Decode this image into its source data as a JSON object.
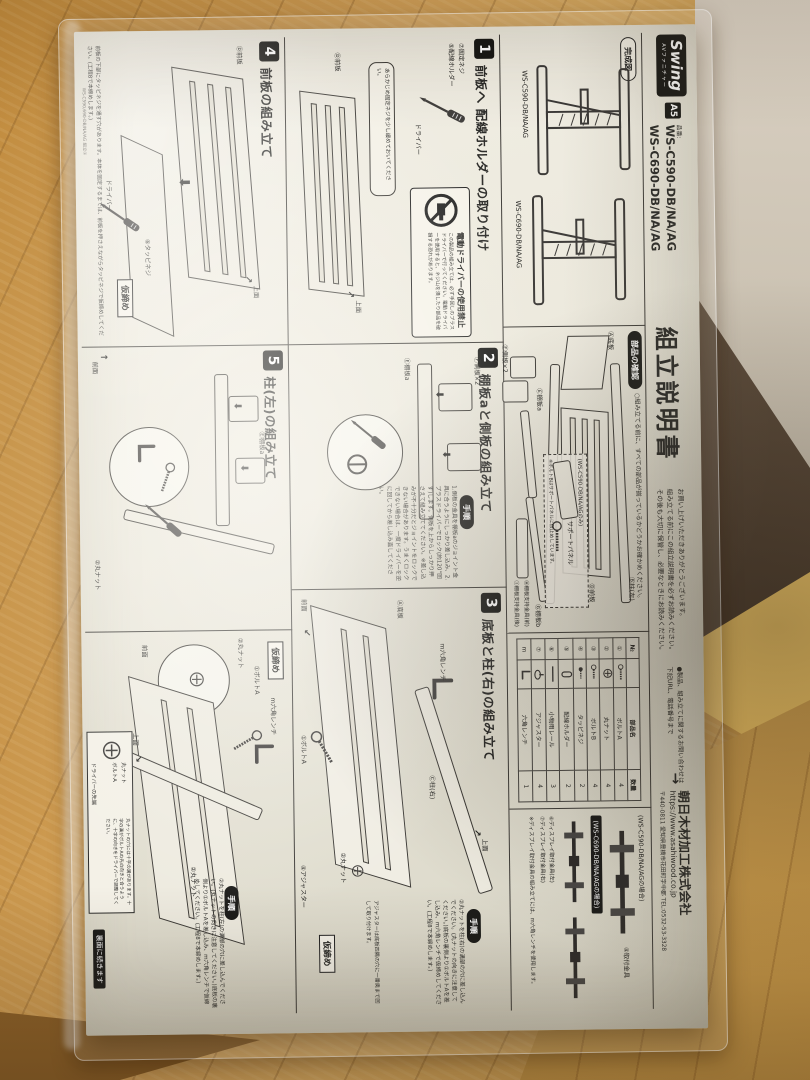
{
  "common": {
    "proc_badge": "手順",
    "temp_tighten": "仮締め",
    "top_face": "上面",
    "front_face": "前面"
  },
  "header": {
    "logo": "Swing",
    "logo_sub": "AVファニチャー",
    "size_badge": "A5",
    "part_no_label": "品番:",
    "model_1": "WS-C590-DB/NA/AG",
    "model_2": "WS-C690-DB/NA/AG",
    "title": "組立説明書",
    "intro_1": "お買い上げいただきありがとうございます。",
    "intro_2": "組み立てる前にこの組立説明書を必ずお読みください。",
    "intro_3": "その後も大切に保管し、必要なときにお読みください。",
    "contact_1": "●製品、組み立てに関するお問い合わせは",
    "contact_2": "下記URL、電話番号まで",
    "arrow": "→",
    "company": "朝日木材加工株式会社",
    "url": "https://www.asahiwood.co.jp",
    "address": "〒440-0811 愛知県豊橋市花田町字中郡 TEL:0532-53-3328"
  },
  "kansei": {
    "badge": "完成図",
    "model_1": "WS-C590-DB/NA/AG",
    "model_2": "WS-C690-DB/NA/AG"
  },
  "parts_check": {
    "badge": "部品の確認",
    "note": "○組み立てる前に、すべての部品が揃っているかどうかお確かめください。",
    "item_a": "Ⓐ底板",
    "item_b": "Ⓑ柱(左)",
    "item_c": "Ⓒ柱(右)",
    "item_d": "Ⓓ前板",
    "item_e": "Ⓔ棚板a",
    "item_f": "Ⓕ側板×2",
    "item_g": "Ⓖ棚板b",
    "item_h": "Ⓗ棚板支持金具(前)",
    "item_i": "Ⓘ棚板支持金具(後)",
    "support_case": "(WS-C590-DB/NA/AGのみ)",
    "support_label": "サポートパネル",
    "support_note": "※ボルトBはサポートパネルに仮止めしています。"
  },
  "parts_table": {
    "h_no": "№",
    "h_name": "部品名",
    "h_qty": "数量",
    "rows": [
      {
        "no": "①",
        "name": "ボルトA",
        "qty": "4"
      },
      {
        "no": "②",
        "name": "丸ナット",
        "qty": "4"
      },
      {
        "no": "③",
        "name": "ボルトB",
        "qty": "4"
      },
      {
        "no": "④",
        "name": "タッピネジ",
        "qty": "2"
      },
      {
        "no": "⑤",
        "name": "配線ホルダー",
        "qty": "2"
      },
      {
        "no": "⑥",
        "name": "小物用レール",
        "qty": "3"
      },
      {
        "no": "⑦",
        "name": "アジャスター",
        "qty": "4"
      },
      {
        "no": "m",
        "name": "六角レンチ",
        "qty": "1"
      }
    ]
  },
  "steps": [
    {
      "num": "1",
      "title": "前板へ 配線ホルダーの取り付け",
      "warn_title": "電動ドライバーの使用禁止",
      "warn_text": "この製品の組み立ては、必ず手回しのプラスドライバーで行ってください。電動ドライバーを使用すると、ネジ山を潰したり部品を破損する恐れがあります。",
      "lbl_holder": "⑤配線ホルダー",
      "lbl_screw": "⑦固定ネジ",
      "lbl_driver": "ドライバー",
      "lbl_panel": "Ⓓ前板",
      "note": "あらかじめ固定ネジを少し緩めておいてください。"
    },
    {
      "num": "2",
      "title": "棚板aと側板の組み立て",
      "text": "1.側板の金具を棚板aのジョイント金具に合うようにしっかり差し込み、2.プラスドライバーでロック(約120°回す)します。側板を上からしっかり押さえて組み立ててください。※差し込みが不十分だとジョイントをロックできない場合があります。うまくロックできない場合は、一度ドライバーを逆に回してから差し込み直してください。",
      "lbl_side": "Ⓕ側板×2",
      "lbl_shelf": "Ⓔ棚板a"
    },
    {
      "num": "3",
      "title": "底板と柱(右)の組み立て",
      "text": "②丸ナットを柱(右)の溝部の穴に差し込んでください。(丸ナットの向きに注意してください。)底板の裏側より①ボルトAを差し込み、m六角レンチで仮締めしてください。(工程8で本締めします。)",
      "note": "アジャスターは底板四隅の穴に一番奥まで回して取り付けます。",
      "lbl_pillar": "Ⓒ柱(右)",
      "lbl_base": "Ⓐ底板",
      "lbl_nut": "②丸ナット",
      "lbl_bolt": "①ボルトA",
      "lbl_wrench": "m六角レンチ",
      "lbl_adj": "④アジャスター"
    },
    {
      "num": "4",
      "title": "前板の組み立て",
      "lbl_panel": "Ⓓ前板",
      "lbl_screw": "⑥タッピネジ",
      "lbl_driver": "ドライバー",
      "note": "前板の下部にタッピネジを通す穴があります。本体を固定するまでは、前板を押さえながらタッピネジで仮締めしてください。(工程8で本締めします。)"
    },
    {
      "num": "5",
      "title": "柱(左)の組み立て",
      "lbl_shelf": "Ⓔ棚板a",
      "lbl_nut": "②丸ナット"
    }
  ],
  "final_panel": {
    "text": "②丸ナットを柱(左)の溝部の穴に差し込んでください。(丸ナットの向きに注意してください。)底板の裏側より①ボルトAを差し込み、m六角レンチで仮締めしてください。(工程8で本締めします。)",
    "lbl_wrench": "m六角レンチ",
    "lbl_bolt": "①ボルトA",
    "lbl_nut": "②丸ナット",
    "lbl_nut2": "②丸ナット",
    "inset_nut": "丸ナット",
    "inset_bolt": "ボルトA",
    "inset_tip": "ドライバーの先端",
    "inset_text": "丸ナットの穴には十字の溝があります。十字の溝がボルトAの先の向きと合うように、十字の向きをドライバーで調整してください。"
  },
  "bracket_panel": {
    "case_590": "(WS-C590-DB/NA/AGの場合)",
    "callout_590": "④取付金具",
    "case_690": "(WS-C690-DB/NA/AGの場合)",
    "callout_690a": "⑥ディスプレイ取付金具(左)",
    "callout_690b": "⑦ディスプレイ取付金具(右)",
    "note": "※ディスプレイ取付金具の組み立てには、m六角レンチを使用します。"
  },
  "footer": {
    "continue_badge": "裏面に続きます",
    "margin_code": "WS-C590,690-DB/NA/AG 組立①"
  },
  "colors": {
    "ink": "#2a2a28",
    "paper": "#efece2",
    "wood": "#cf9d50",
    "accent_black": "#1c1c1a"
  }
}
